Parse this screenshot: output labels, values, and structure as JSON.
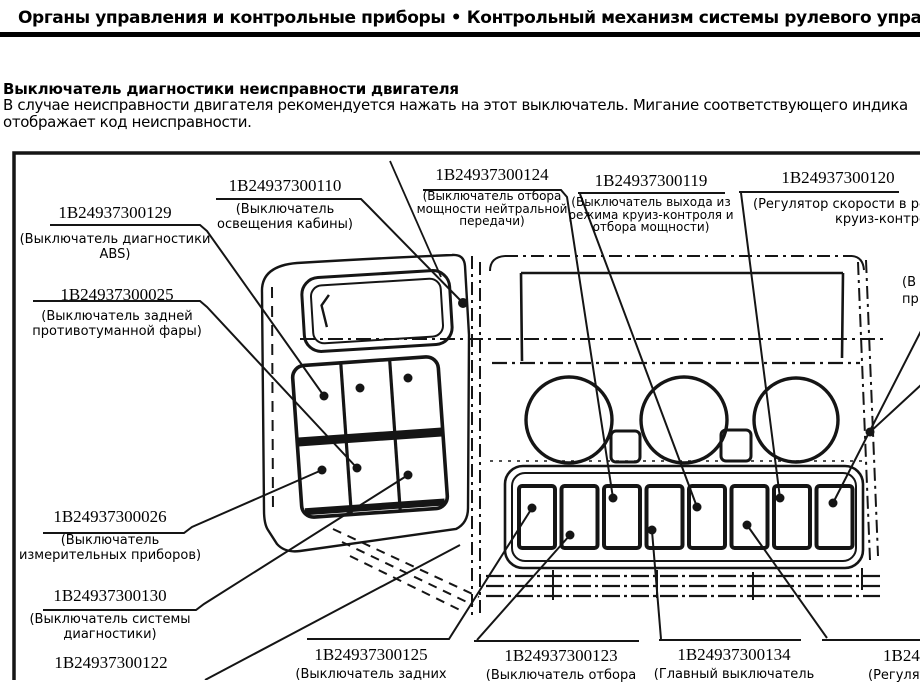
{
  "header": {
    "title": "Органы управления и контрольные приборы • Контрольный механизм системы рулевого управления"
  },
  "article": {
    "heading": "Выключатель диагностики неисправности двигателя",
    "body_lines": [
      "В случае неисправности двигателя рекомендуется нажать на этот выключатель. Мигание соответствующего индика",
      "отображает код неисправности."
    ]
  },
  "diagram": {
    "description": "Схема панелей выключателей приборной панели",
    "callouts": [
      {
        "part_number": "1В24937300129",
        "desc_lines": [
          "(Выключатель диагностики",
          "ABS)"
        ]
      },
      {
        "part_number": "1В24937300025",
        "desc_lines": [
          "(Выключатель задней",
          "противотуманной фары)"
        ]
      },
      {
        "part_number": "1В24937300110",
        "desc_lines": [
          "(Выключатель",
          "освещения кабины)"
        ]
      },
      {
        "part_number": "1В24937300124",
        "desc_lines": [
          "(Выключатель отбора",
          "мощности нейтральной",
          "передачи)"
        ]
      },
      {
        "part_number": "1В24937300119",
        "desc_lines": [
          "(Выключатель выхода из",
          "режима круиз-контроля и",
          "отбора мощности)"
        ]
      },
      {
        "part_number": "1В24937300120",
        "desc_lines": [
          "(Регулятор скорости в режи",
          "круиз-контроля (-))"
        ]
      },
      {
        "part_number": "1В24937300026",
        "desc_lines": [
          "(Выключатель",
          "измерительных приборов)"
        ]
      },
      {
        "part_number": "1В24937300130",
        "desc_lines": [
          "(Выключатель системы",
          "диагностики)"
        ]
      },
      {
        "part_number": "1В24937300122",
        "desc_lines": []
      },
      {
        "part_number": "1В24937300125",
        "desc_lines": [
          "(Выключатель задних"
        ]
      },
      {
        "part_number": "1В24937300123",
        "desc_lines": [
          "(Выключатель отбора"
        ]
      },
      {
        "part_number": "1В24937300134",
        "desc_lines": [
          "(Главный выключатель"
        ]
      },
      {
        "part_number": "1В24",
        "desc_lines": [
          "(Регулято"
        ]
      },
      {
        "part_number": "",
        "desc_lines": [
          "(В",
          "пр"
        ]
      }
    ]
  }
}
